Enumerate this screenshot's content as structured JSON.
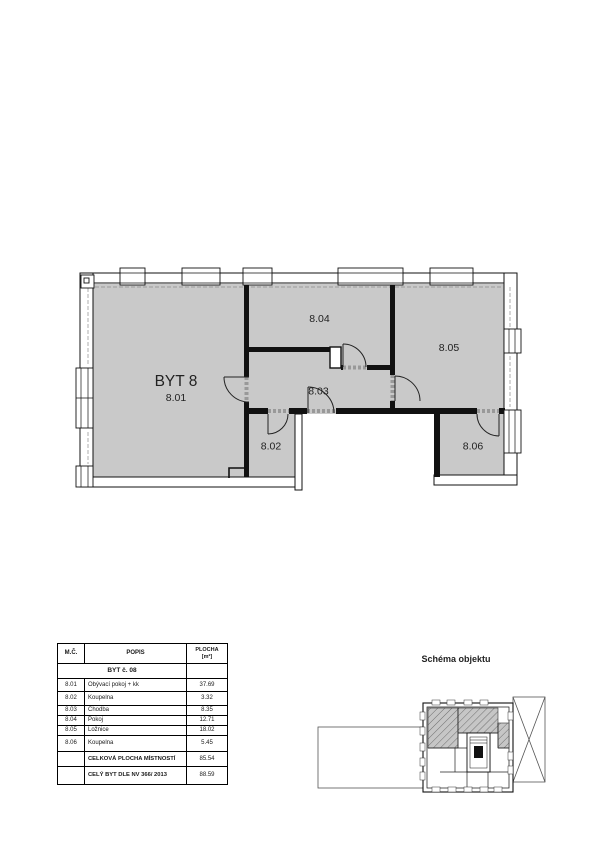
{
  "plan": {
    "apartment_title": "BYT 8",
    "room_numbers": {
      "r801": "8.01",
      "r802": "8.02",
      "r803": "8.03",
      "r804": "8.04",
      "r805": "8.05",
      "r806": "8.06"
    }
  },
  "table": {
    "header": {
      "mc": "M.Č.",
      "popis": "POPIS",
      "plocha_line1": "PLOCHA",
      "plocha_line2": "[m²]"
    },
    "subheader": "BYT č. 08",
    "rows": [
      {
        "id": "8.01",
        "popis": "Obývací pokoj + kk",
        "plocha": "37.69"
      },
      {
        "id": "8.02",
        "popis": "Koupelna",
        "plocha": "3.32"
      },
      {
        "id": "8.03",
        "popis": "Chodba",
        "plocha": "8.35"
      },
      {
        "id": "8.04",
        "popis": "Pokoj",
        "plocha": "12.71"
      },
      {
        "id": "8.05",
        "popis": "Ložnice",
        "plocha": "18.02"
      },
      {
        "id": "8.06",
        "popis": "Koupelna",
        "plocha": "5.45"
      }
    ],
    "totals": [
      {
        "label": "CELKOVÁ PLOCHA MÍSTNOSTÍ",
        "value": "85.54"
      },
      {
        "label": "CELÝ BYT  DLE NV 366/ 2013",
        "value": "88.59"
      }
    ]
  },
  "schema": {
    "title": "Schéma objektu"
  },
  "colors": {
    "room_fill": "#c9c9c9",
    "wall": "#111111"
  }
}
